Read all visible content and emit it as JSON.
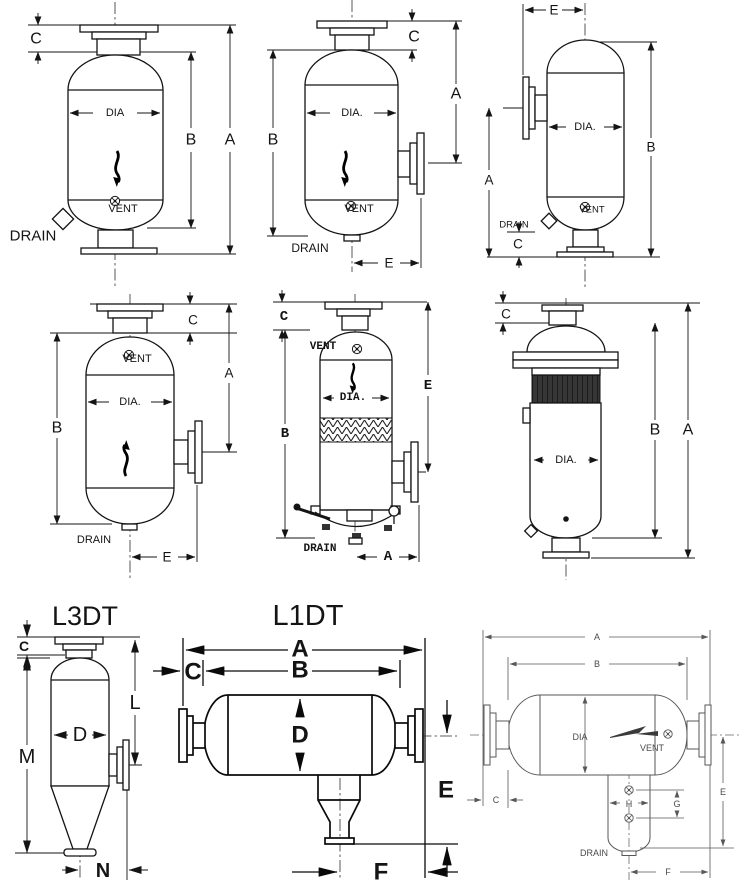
{
  "p1": {
    "c": "C",
    "b": "B",
    "a": "A",
    "dia": "DIA",
    "vent": "VENT",
    "drain": "DRAIN"
  },
  "p2": {
    "c": "C",
    "a": "A",
    "b": "B",
    "dia": "DIA.",
    "vent": "VENT",
    "drain": "DRAIN",
    "e": "E"
  },
  "p3": {
    "e": "E",
    "a": "A",
    "b": "B",
    "dia": "DIA.",
    "vent": "VENT",
    "drain": "DRAIN",
    "c": "C"
  },
  "p4": {
    "c": "C",
    "a": "A",
    "b": "B",
    "vent": "VENT",
    "dia": "DIA.",
    "drain": "DRAIN",
    "e": "E"
  },
  "p5": {
    "c": "C",
    "b": "B",
    "e": "E",
    "vent": "VENT",
    "dia": "DIA.",
    "drain": "DRAIN",
    "a": "A"
  },
  "p6": {
    "c": "C",
    "b": "B",
    "a": "A",
    "dia": "DIA."
  },
  "p7": {
    "title": "L3DT",
    "c": "C",
    "d": "D",
    "l": "L",
    "m": "M",
    "n": "N"
  },
  "p8": {
    "title": "L1DT",
    "a": "A",
    "b": "B",
    "c": "C",
    "d": "D",
    "e": "E",
    "f": "F"
  },
  "p9": {
    "a": "A",
    "b": "B",
    "dia": "DIA",
    "vent": "VENT",
    "drain": "DRAIN",
    "c": "C",
    "e": "E",
    "f": "F",
    "g": "G",
    "h": "H"
  }
}
